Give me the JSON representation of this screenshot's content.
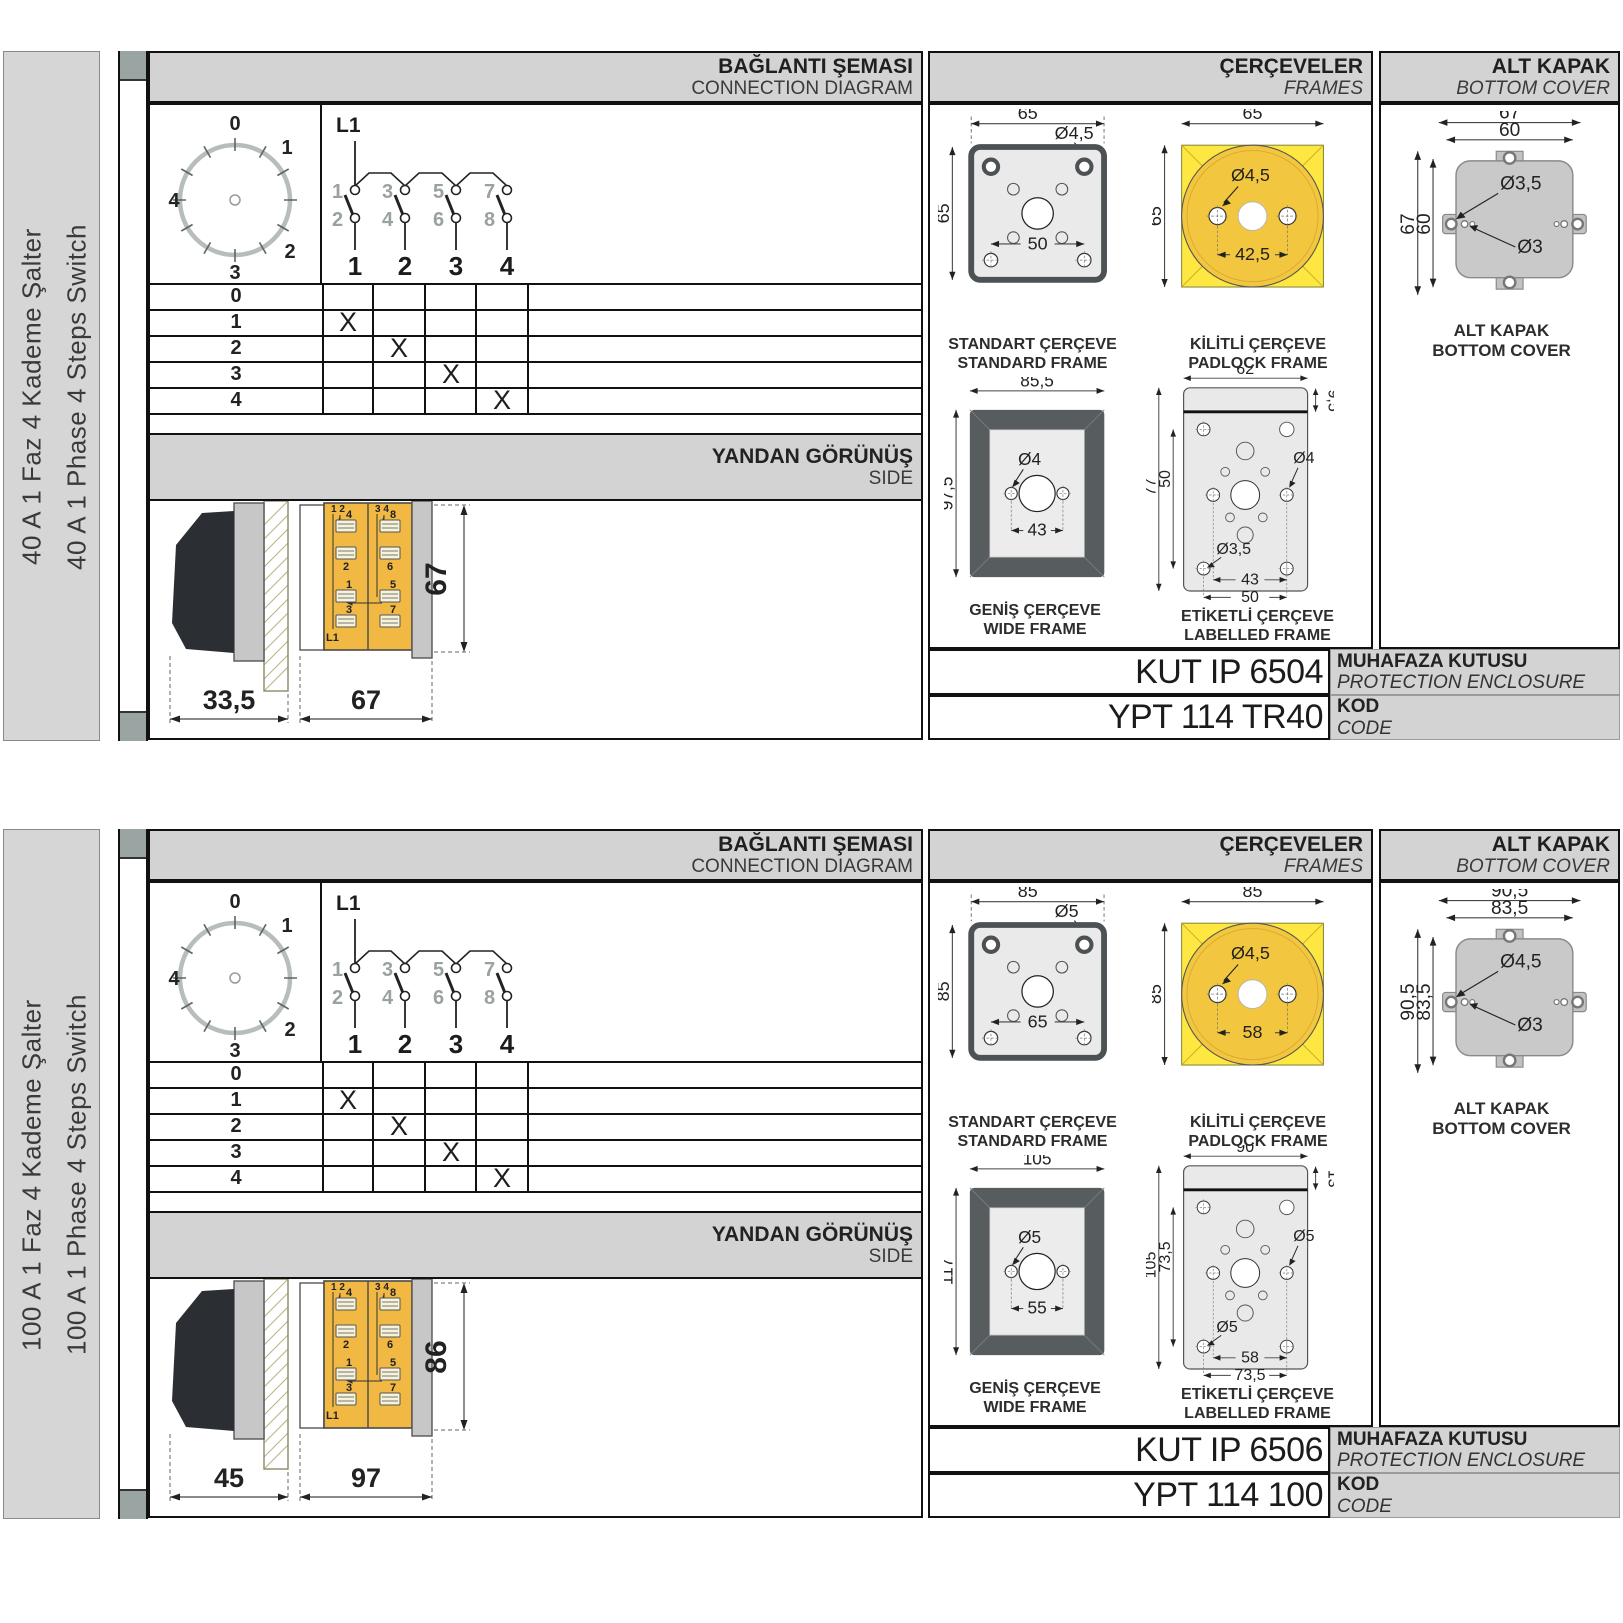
{
  "sections": [
    {
      "sidebar": {
        "title_tr": "40 A 1 Faz 4 Kademe Şalter",
        "title_en": "40 A 1 Phase 4 Steps Switch"
      },
      "headers": {
        "connection_tr": "BAĞLANTI ŞEMASI",
        "connection_en": "CONNECTION DIAGRAM",
        "frames_tr": "ÇERÇEVELER",
        "frames_en": "FRAMES",
        "cover_tr": "ALT KAPAK",
        "cover_en": "BOTTOM COVER"
      },
      "dial": {
        "positions": [
          "0",
          "1",
          "2",
          "3",
          "4"
        ]
      },
      "schematic": {
        "feed": "L1",
        "top_contacts": [
          "1",
          "3",
          "5",
          "7"
        ],
        "bottom_contacts": [
          "2",
          "4",
          "6",
          "8"
        ],
        "outputs": [
          "1",
          "2",
          "3",
          "4"
        ]
      },
      "table": {
        "rows": [
          {
            "label": "0",
            "marks": [
              "",
              "",
              "",
              ""
            ]
          },
          {
            "label": "1",
            "marks": [
              "X",
              "",
              "",
              ""
            ]
          },
          {
            "label": "2",
            "marks": [
              "",
              "X",
              "",
              ""
            ]
          },
          {
            "label": "3",
            "marks": [
              "",
              "",
              "X",
              ""
            ]
          },
          {
            "label": "4",
            "marks": [
              "",
              "",
              "",
              "X"
            ]
          }
        ]
      },
      "side_view": {
        "title_tr": "YANDAN GÖRÜNÜŞ",
        "title_en": "SIDE",
        "dim_knob": "33,5",
        "dim_body": "67",
        "dim_height": "67",
        "top_left_terminals": "1 2",
        "top_right_terminals": "3 4",
        "left_terminals": [
          "4",
          "2",
          "1",
          "3"
        ],
        "right_terminals": [
          "8",
          "6",
          "5",
          "7"
        ],
        "feed": "L1"
      },
      "frames": {
        "standard": {
          "name_tr": "STANDART ÇERÇEVE",
          "name_en": "STANDARD FRAME",
          "width": "65",
          "height": "65",
          "hole": "Ø4,5",
          "spacing": "50"
        },
        "padlock": {
          "name_tr": "KİLİTLİ ÇERÇEVE",
          "name_en": "PADLOCK FRAME",
          "width": "65",
          "height": "65",
          "hole": "Ø4,5",
          "spacing": "42,5"
        },
        "wide": {
          "name_tr": "GENİŞ ÇERÇEVE",
          "name_en": "WIDE FRAME",
          "width": "85,5",
          "height": "97,5",
          "hole": "Ø4",
          "spacing": "43"
        },
        "labelled": {
          "name_tr": "ETİKETLİ ÇERÇEVE",
          "name_en": "LABELLED FRAME",
          "width": "62",
          "strip": "9,5",
          "height": "77",
          "hole_span": "50",
          "hole_right": "Ø4",
          "hole_left": "Ø3,5",
          "spacing_inner": "43",
          "spacing_outer": "50"
        }
      },
      "cover": {
        "name_tr": "ALT KAPAK",
        "name_en": "BOTTOM COVER",
        "width_outer": "67",
        "width_inner": "60",
        "height_outer": "67",
        "height_inner": "60",
        "hole_tab": "Ø3,5",
        "hole_small": "Ø3"
      },
      "enclosure": {
        "code": "KUT IP 6504",
        "label_tr": "MUHAFAZA KUTUSU",
        "label_en": "PROTECTION ENCLOSURE"
      },
      "product": {
        "code": "YPT 114 TR40",
        "label_tr": "KOD",
        "label_en": "CODE"
      }
    },
    {
      "sidebar": {
        "title_tr": "100 A 1 Faz 4 Kademe Şalter",
        "title_en": "100 A 1 Phase 4 Steps Switch"
      },
      "headers": {
        "connection_tr": "BAĞLANTI ŞEMASI",
        "connection_en": "CONNECTION DIAGRAM",
        "frames_tr": "ÇERÇEVELER",
        "frames_en": "FRAMES",
        "cover_tr": "ALT KAPAK",
        "cover_en": "BOTTOM COVER"
      },
      "dial": {
        "positions": [
          "0",
          "1",
          "2",
          "3",
          "4"
        ]
      },
      "schematic": {
        "feed": "L1",
        "top_contacts": [
          "1",
          "3",
          "5",
          "7"
        ],
        "bottom_contacts": [
          "2",
          "4",
          "6",
          "8"
        ],
        "outputs": [
          "1",
          "2",
          "3",
          "4"
        ]
      },
      "table": {
        "rows": [
          {
            "label": "0",
            "marks": [
              "",
              "",
              "",
              ""
            ]
          },
          {
            "label": "1",
            "marks": [
              "X",
              "",
              "",
              ""
            ]
          },
          {
            "label": "2",
            "marks": [
              "",
              "X",
              "",
              ""
            ]
          },
          {
            "label": "3",
            "marks": [
              "",
              "",
              "X",
              ""
            ]
          },
          {
            "label": "4",
            "marks": [
              "",
              "",
              "",
              "X"
            ]
          }
        ]
      },
      "side_view": {
        "title_tr": "YANDAN GÖRÜNÜŞ",
        "title_en": "SIDE",
        "dim_knob": "45",
        "dim_body": "97",
        "dim_height": "86",
        "top_left_terminals": "1 2",
        "top_right_terminals": "3 4",
        "left_terminals": [
          "4",
          "2",
          "1",
          "3"
        ],
        "right_terminals": [
          "8",
          "6",
          "5",
          "7"
        ],
        "feed": "L1"
      },
      "frames": {
        "standard": {
          "name_tr": "STANDART ÇERÇEVE",
          "name_en": "STANDARD FRAME",
          "width": "85",
          "height": "85",
          "hole": "Ø5",
          "spacing": "65"
        },
        "padlock": {
          "name_tr": "KİLİTLİ ÇERÇEVE",
          "name_en": "PADLOCK FRAME",
          "width": "85",
          "height": "85",
          "hole": "Ø4,5",
          "spacing": "58"
        },
        "wide": {
          "name_tr": "GENİŞ ÇERÇEVE",
          "name_en": "WIDE FRAME",
          "width": "105",
          "height": "117",
          "hole": "Ø5",
          "spacing": "55"
        },
        "labelled": {
          "name_tr": "ETİKETLİ ÇERÇEVE",
          "name_en": "LABELLED FRAME",
          "width": "90",
          "strip": "13",
          "height": "105",
          "hole_span": "73,5",
          "hole_right": "Ø5",
          "hole_left": "Ø5",
          "spacing_inner": "58",
          "spacing_outer": "73,5"
        }
      },
      "cover": {
        "name_tr": "ALT KAPAK",
        "name_en": "BOTTOM COVER",
        "width_outer": "90,5",
        "width_inner": "83,5",
        "height_outer": "90,5",
        "height_inner": "83,5",
        "hole_tab": "Ø4,5",
        "hole_small": "Ø3"
      },
      "enclosure": {
        "code": "KUT IP 6506",
        "label_tr": "MUHAFAZA KUTUSU",
        "label_en": "PROTECTION ENCLOSURE"
      },
      "product": {
        "code": "YPT 114 100",
        "label_tr": "KOD",
        "label_en": "CODE"
      }
    }
  ]
}
